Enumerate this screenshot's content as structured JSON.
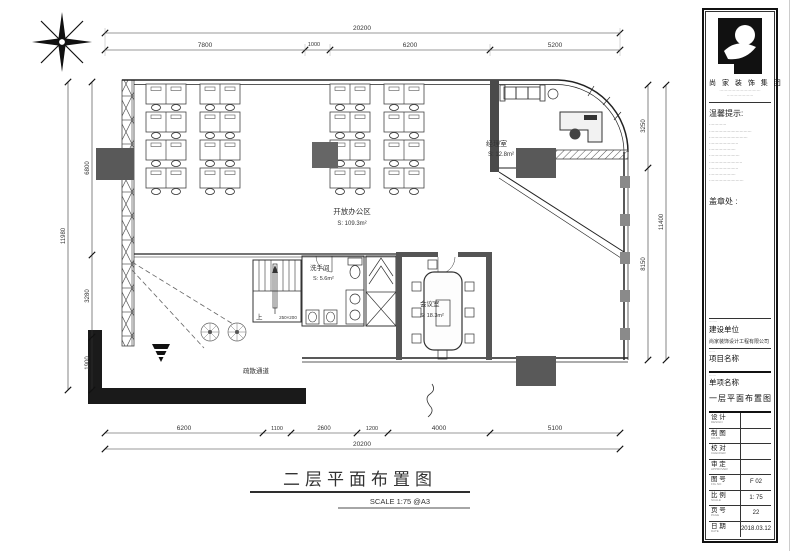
{
  "plan": {
    "title": "二层平面布置图",
    "scale": "SCALE 1:75 @A3",
    "rooms": {
      "office": {
        "name": "开放办公区",
        "area": "S: 109.3m²"
      },
      "manager": {
        "name": "经理室",
        "area": "S: 12.8m²"
      },
      "wc": {
        "name": "洗手间",
        "area": "S: 5.6m²"
      },
      "meeting": {
        "name": "会议室",
        "area": "S: 18.3m²"
      }
    },
    "notes": {
      "up": "上",
      "stair": "250×200",
      "evac": "疏散通道"
    },
    "dims": {
      "top_total": "20200",
      "top": [
        "7800",
        "1000",
        "6200",
        "5200"
      ],
      "bottom_total": "20200",
      "bottom": [
        "6200",
        "1100",
        "2600",
        "1200",
        "4000",
        "5100"
      ],
      "left": [
        "6800",
        "3280",
        "1900"
      ],
      "left_total": "11980",
      "right": [
        "3250",
        "8150"
      ],
      "right_total": "11400"
    }
  },
  "tb": {
    "company": "尚 家 装 饰 集 团",
    "company_sub1": "·······························",
    "company_sub2": "····················",
    "notice_title": "温馨提示:",
    "notice": [
      "·············",
      "································",
      "·····························",
      "······················",
      "····················",
      "·······················",
      "·························",
      "······················",
      "····················",
      "··························"
    ],
    "stamp": "盖章处 :",
    "sections": [
      {
        "en": "·······",
        "label": "建设单位",
        "value": "尚家装饰设计工程有限公司"
      },
      {
        "en": "·····",
        "label": "项目名称",
        "value": ""
      },
      {
        "en": "······",
        "label": "单项名称",
        "value": ""
      }
    ],
    "sub_item_value": "一层平面布置图",
    "table": [
      {
        "label": "设  计",
        "en": "DESIGN",
        "value": ""
      },
      {
        "label": "制  图",
        "en": "DRAW",
        "value": ""
      },
      {
        "label": "校  对",
        "en": "CHECKER",
        "value": ""
      },
      {
        "label": "审  定",
        "en": "APPROVER",
        "value": ""
      },
      {
        "label": "图  号",
        "en": "FIG.NO",
        "value": "F 02"
      },
      {
        "label": "比  例",
        "en": "SCALE",
        "value": "1: 75"
      },
      {
        "label": "页  号",
        "en": "PAGE",
        "value": "22"
      },
      {
        "label": "日  期",
        "en": "DATE",
        "value": "2018.03.12"
      }
    ]
  }
}
